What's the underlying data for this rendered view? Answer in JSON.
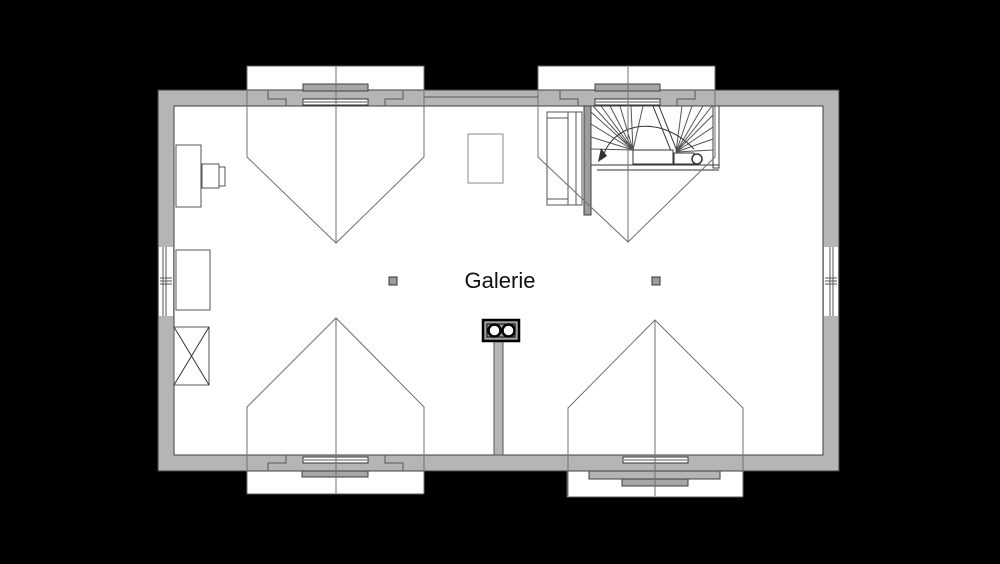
{
  "canvas": {
    "width": 1000,
    "height": 564,
    "background": "#000000"
  },
  "plan": {
    "room_label": "Galerie",
    "colors": {
      "background": "#000000",
      "wall_fill": "#b5b5b5",
      "wall_outline": "#3f3f3f",
      "floor_fill": "#ffffff",
      "roof_line": "#707070",
      "fixture_fill": "#a6a6a6",
      "stair_wall_fill": "#9c9c9c",
      "label_color": "#111111"
    },
    "elements": {
      "dormer_window_count": 4,
      "staircase": "winder-staircase-with-walkline-arrow",
      "chimney": "double-flue-chimney-with-duct",
      "posts": 2,
      "furniture": [
        "desk",
        "chair",
        "sideboard",
        "crossed-cabinet",
        "shelf",
        "skylight"
      ]
    }
  }
}
